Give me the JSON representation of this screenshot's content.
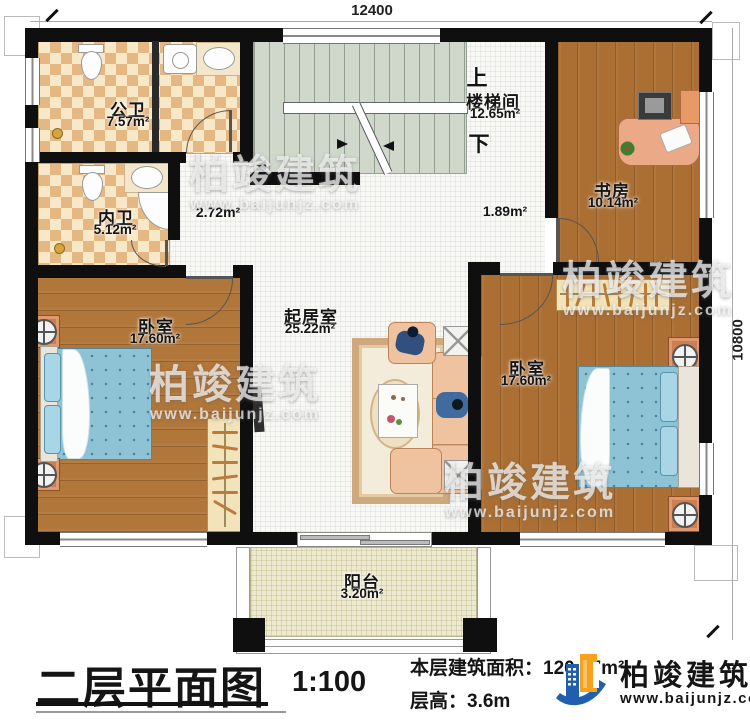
{
  "dimensions": {
    "top": "12400",
    "right": "10800"
  },
  "rooms": {
    "public_bath": {
      "name": "公卫",
      "area": "7.57m²"
    },
    "ensuite_bath": {
      "name": "内卫",
      "area": "5.12m²"
    },
    "stairwell": {
      "name": "楼梯间",
      "area": "12.65m²",
      "up": "上",
      "down": "下"
    },
    "study": {
      "name": "书房",
      "area": "10.14m²"
    },
    "bedroom_left": {
      "name": "卧室",
      "area": "17.60m²"
    },
    "living": {
      "name": "起居室",
      "area": "25.22m²"
    },
    "bedroom_right": {
      "name": "卧室",
      "area": "17.60m²"
    },
    "balcony": {
      "name": "阳台",
      "area": "3.20m²"
    },
    "hall_front": {
      "area": "2.72m²"
    },
    "hall_back": {
      "area": "1.89m²"
    }
  },
  "footer": {
    "title": "二层平面图",
    "scale": "1:100",
    "floor_area": "本层建筑面积：120.97m²",
    "floor_height": "层高：3.6m"
  },
  "brand": {
    "name": "柏竣建筑",
    "url": "www.baijunjz.com"
  },
  "watermark": {
    "name": "柏竣建筑",
    "url": "www.baijunjz.com"
  },
  "colors": {
    "wall": "#0f0f0f",
    "wood": "#b0763a",
    "tile_dark": "#e5b783",
    "tile_light": "#f7e9c8",
    "stairs": "#cfd8cb",
    "balcony": "#edeacf",
    "bed": "#8ec3d6",
    "accent_orange": "#cd7f52",
    "brand_blue": "#1f5fae",
    "brand_orange": "#f6a21c"
  }
}
